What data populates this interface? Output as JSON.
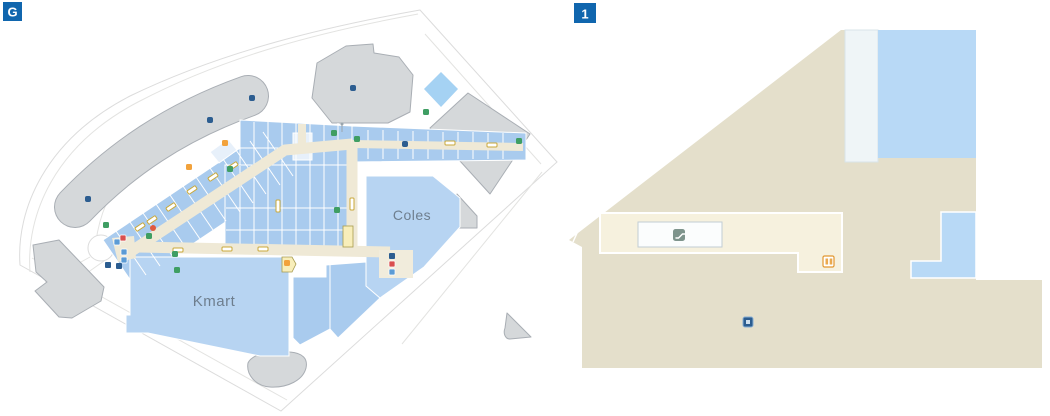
{
  "app": {
    "type": "shopping-centre-indoor-floor-maps",
    "floors_shown": [
      "G",
      "1"
    ]
  },
  "floor_selector": {
    "ground_label": "G",
    "level1_label": "1"
  },
  "ground_map": {
    "anchor_stores": [
      {
        "label": "Kmart"
      },
      {
        "label": "Coles"
      }
    ],
    "features": {
      "carparks": 5,
      "parking_dots": 5,
      "roundabout": 1,
      "benches": 11,
      "amenity_icons_green": 10,
      "amenity_icons_orange": 3,
      "entrance_icon_clusters": 2
    }
  },
  "level1_map": {
    "icons": [
      "escalator",
      "lift",
      "poi"
    ],
    "features": {
      "walkway": 1,
      "stores_blue": 2
    }
  },
  "colors": {
    "badge_blue": "#1066ae",
    "store_blue": "#a9cbee",
    "anchor_blue": "#b7d4f2",
    "pale_store_blue": "#e7f0fa",
    "diamond_blue": "#a5d2f3",
    "walkway_cream": "#efe9d6",
    "walkway_cream_light": "#f6f1de",
    "building_gray": "#d5d8da",
    "building_gray_border": "#a9aeb4",
    "level_beige": "#e4dfcb",
    "road_line": "#dfdfdf",
    "poi_navy": "#2c5d90",
    "amenity_green": "#3f9e63",
    "amenity_orange": "#f2a23c",
    "amenity_red": "#d94f4f",
    "amenity_lightblue": "#5b9bd5",
    "bench_yellow": "#c9a83a",
    "escalator_gray_green": "#7e948c",
    "lift_orange": "#e2972f",
    "label_gray": "#6e7e8e"
  }
}
